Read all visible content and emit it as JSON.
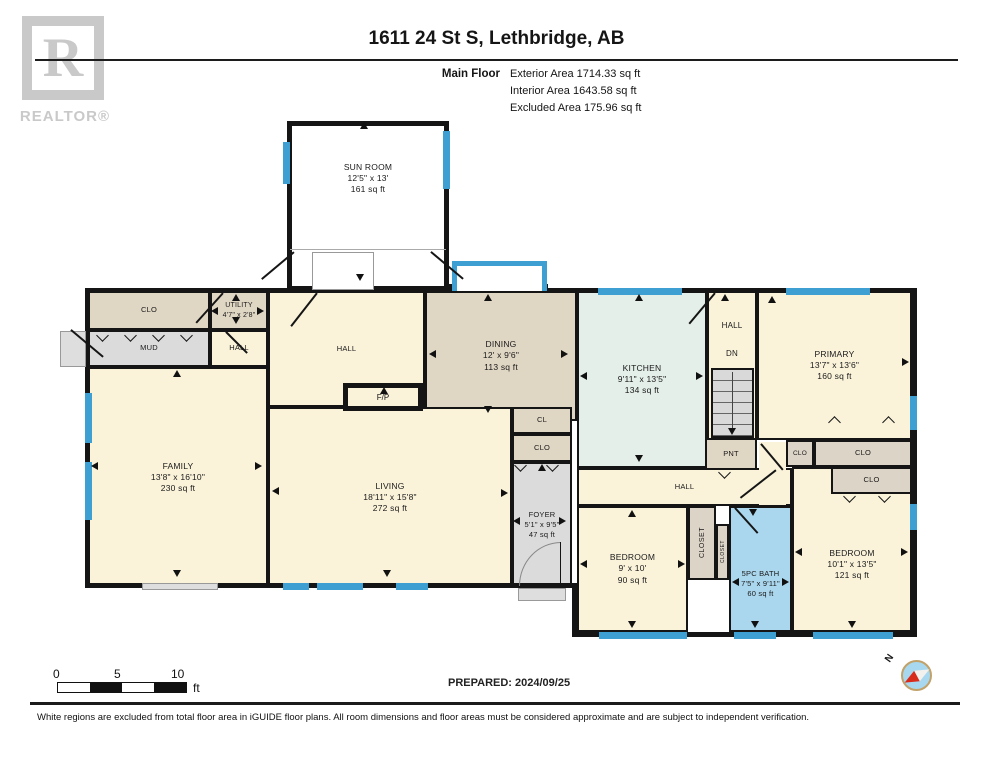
{
  "header": {
    "logo_r": "R",
    "logo_sub": "REALTOR®",
    "title": "1611 24 St S, Lethbridge, AB",
    "floor_label": "Main Floor",
    "area_lines": {
      "exterior": "Exterior Area 1714.33 sq ft",
      "interior": "Interior Area 1643.58 sq ft",
      "excluded": "Excluded Area 175.96 sq ft"
    }
  },
  "rooms": {
    "sun_room": {
      "name": "SUN ROOM",
      "dims": "12'5\" x 13'",
      "area": "161 sq ft"
    },
    "clo_top_left": {
      "name": "CLO"
    },
    "utility": {
      "name": "UTILITY",
      "dims": "4'7\" x 2'8\""
    },
    "mud": {
      "name": "MUD"
    },
    "hall_mud": {
      "name": "HALL"
    },
    "family": {
      "name": "FAMILY",
      "dims": "13'8\" x 16'10\"",
      "area": "230 sq ft"
    },
    "hall_center": {
      "name": "HALL"
    },
    "fireplace": {
      "name": "F/P"
    },
    "dining": {
      "name": "DINING",
      "dims": "12' x 9'6\"",
      "area": "113 sq ft"
    },
    "living": {
      "name": "LIVING",
      "dims": "18'11\" x 15'8\"",
      "area": "272 sq ft"
    },
    "cl": {
      "name": "CL"
    },
    "clo_foyer": {
      "name": "CLO"
    },
    "foyer": {
      "name": "FOYER",
      "dims": "5'1\" x 9'5\"",
      "area": "47 sq ft"
    },
    "kitchen": {
      "name": "KITCHEN",
      "dims": "9'11\" x 13'5\"",
      "area": "134 sq ft"
    },
    "hall_stairs": {
      "name": "HALL"
    },
    "dn": {
      "name": "DN"
    },
    "pnt": {
      "name": "PNT"
    },
    "hall_bottom": {
      "name": "HALL"
    },
    "bedroom_mid": {
      "name": "BEDROOM",
      "dims": "9' x 10'",
      "area": "90 sq ft"
    },
    "closet_a": {
      "name": "CLOSET"
    },
    "closet_b": {
      "name": "CLOSET"
    },
    "bath": {
      "name": "5PC BATH",
      "dims": "7'5\" x 9'11\"",
      "area": "60 sq ft"
    },
    "bedroom_right": {
      "name": "BEDROOM",
      "dims": "10'1\" x 13'5\"",
      "area": "121 sq ft"
    },
    "primary": {
      "name": "PRIMARY",
      "dims": "13'7\" x 13'6\"",
      "area": "160 sq ft"
    },
    "clo_r1": {
      "name": "CLO"
    },
    "clo_r2": {
      "name": "CLO"
    },
    "clo_r3": {
      "name": "CLO"
    }
  },
  "footer": {
    "scale": {
      "t0": "0",
      "t5": "5",
      "t10": "10",
      "unit": "ft"
    },
    "prepared": "PREPARED: 2024/09/25",
    "compass_n": "N",
    "disclaimer": "White regions are excluded from total floor area in iGUIDE floor plans. All room dimensions and floor areas must be considered approximate and are subject to independent verification."
  },
  "colors": {
    "wall": "#151515",
    "window_blue": "#3D9FD2",
    "room_cream": "#FAF3DA",
    "room_tan": "#E0D6C4",
    "room_gray": "#DBDBDB",
    "kitchen_mint": "#E4EFE9",
    "bath_blue": "#ABD7EE",
    "logo_gray": "#C9C9C9",
    "compass_red": "#D92B1C",
    "compass_ring": "#C2A26A",
    "compass_fill": "#A8D8EF"
  }
}
